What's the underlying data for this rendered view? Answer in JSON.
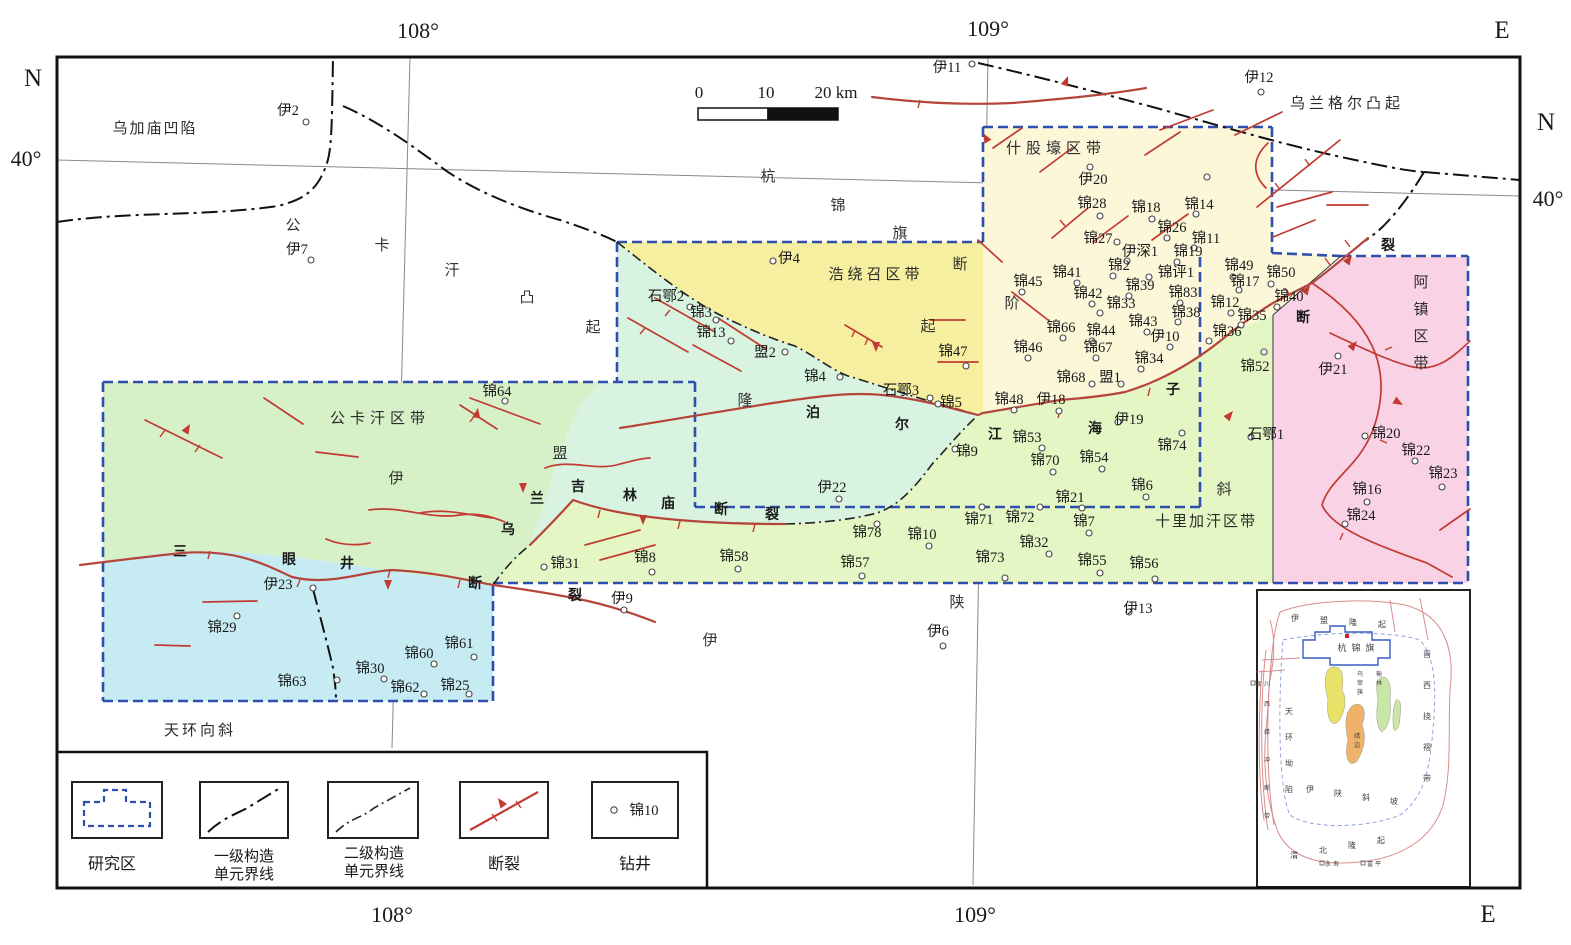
{
  "palette": {
    "study_boundary": "#2e4fae",
    "fault_red": "#c23b32",
    "fault_main": "#b5453b",
    "green_gongkahan": "#d6f0c8",
    "cyan_sanyanjing": "#c6ebf3",
    "mint_long": "#d9f3e1",
    "yellow_haoraozhao": "#f6ef9f",
    "pale_shiguhao": "#fbf7d8",
    "band_shilijiahan": "#e3f6c4",
    "pink_azhen": "#f9d3e5",
    "inset_yellow": "#e9e268",
    "inset_orange": "#efb26b",
    "inset_green": "#c9e6a5"
  },
  "graticule": {
    "top_lon_left": "108°",
    "top_lon_right": "109°",
    "bottom_lon_left": "108°",
    "bottom_lon_right": "109°",
    "left_lat": "40°",
    "right_lat": "40°"
  },
  "compass": {
    "top_e": "E",
    "bottom_e": "E",
    "left_n": "N",
    "right_n": "N"
  },
  "scale_bar": {
    "t0": "0",
    "t10": "10",
    "t20": "20 km"
  },
  "region_labels": [
    {
      "text": "乌加庙凹陷",
      "x": 155,
      "y": 133,
      "ls": 2,
      "size": 15
    },
    {
      "text": "公卡汗区带",
      "x": 380,
      "y": 423,
      "ls": 5,
      "size": 15
    },
    {
      "text": "浩绕召区带",
      "x": 876,
      "y": 279,
      "ls": 4,
      "size": 15
    },
    {
      "text": "什股壕区带",
      "x": 1056,
      "y": 153,
      "ls": 5,
      "size": 15
    },
    {
      "text": "乌兰格尔凸起",
      "x": 1347,
      "y": 108,
      "ls": 4,
      "size": 15
    },
    {
      "text": "十里加汗区带",
      "x": 1206,
      "y": 526,
      "ls": 2,
      "size": 15
    },
    {
      "text": "阿镇区带",
      "x": 1421,
      "y": 287,
      "vertical": true,
      "vs": 27,
      "size": 15
    },
    {
      "text": "天环向斜",
      "x": 200,
      "y": 735,
      "ls": 3,
      "size": 15
    }
  ],
  "scatter_chars": [
    [
      "公",
      293,
      225
    ],
    [
      "卡",
      382,
      245
    ],
    [
      "汗",
      452,
      270
    ],
    [
      "凸",
      527,
      297
    ],
    [
      "起",
      593,
      327
    ],
    [
      "杭",
      768,
      176
    ],
    [
      "锦",
      838,
      205
    ],
    [
      "旗",
      900,
      233
    ],
    [
      "断",
      960,
      264
    ],
    [
      "阶",
      1012,
      303
    ],
    [
      "起",
      928,
      326
    ],
    [
      "隆",
      745,
      400
    ],
    [
      "盟",
      560,
      453
    ],
    [
      "伊",
      396,
      478
    ],
    [
      "伊",
      710,
      640
    ],
    [
      "陕",
      957,
      602
    ],
    [
      "斜",
      1224,
      489
    ]
  ],
  "fault_names": [
    {
      "name": "三眼井断裂",
      "chars": [
        [
          "三",
          180,
          551
        ],
        [
          "眼",
          289,
          559
        ],
        [
          "井",
          347,
          563
        ],
        [
          "断",
          475,
          583
        ],
        [
          "裂",
          575,
          595
        ]
      ]
    },
    {
      "name": "乌兰吉林庙断裂",
      "chars": [
        [
          "乌",
          508,
          529
        ],
        [
          "兰",
          537,
          498
        ],
        [
          "吉",
          578,
          486
        ],
        [
          "林",
          630,
          495
        ],
        [
          "庙",
          668,
          503
        ],
        [
          "断",
          721,
          509
        ],
        [
          "裂",
          772,
          514
        ]
      ]
    },
    {
      "name": "泊尔江海子断裂",
      "chars": [
        [
          "泊",
          813,
          412
        ],
        [
          "尔",
          902,
          424
        ],
        [
          "江",
          995,
          434
        ],
        [
          "海",
          1095,
          428
        ],
        [
          "子",
          1173,
          389
        ]
      ]
    },
    {
      "name": "断裂",
      "chars": [
        [
          "断",
          1303,
          317
        ],
        [
          "裂",
          1388,
          245
        ]
      ]
    }
  ],
  "wells": [
    [
      "伊2",
      288,
      110,
      306,
      122
    ],
    [
      "伊7",
      297,
      249,
      311,
      260
    ],
    [
      "伊4",
      789,
      258,
      773,
      261
    ],
    [
      "伊11",
      947,
      67,
      972,
      64
    ],
    [
      "伊12",
      1259,
      77,
      1261,
      92
    ],
    [
      "石鄂2",
      666,
      296,
      690,
      307
    ],
    [
      "锦3",
      701,
      312,
      716,
      320
    ],
    [
      "锦13",
      711,
      332,
      731,
      341
    ],
    [
      "盟2",
      765,
      352,
      785,
      352
    ],
    [
      "锦4",
      815,
      376,
      840,
      377
    ],
    [
      "锦64",
      497,
      391,
      505,
      401
    ],
    [
      "石鄂3",
      901,
      390,
      930,
      398
    ],
    [
      "锦5",
      951,
      402,
      938,
      404
    ],
    [
      "锦47",
      953,
      351,
      966,
      366
    ],
    [
      "伊20",
      1093,
      179,
      1090,
      167
    ],
    [
      "锦28",
      1092,
      203,
      1100,
      216
    ],
    [
      "锦18",
      1146,
      207,
      1152,
      219
    ],
    [
      "锦14",
      1199,
      204,
      1196,
      214
    ],
    [
      "锦26",
      1172,
      227,
      1167,
      238
    ],
    [
      "锦11",
      1206,
      238,
      1194,
      248
    ],
    [
      "锦27",
      1098,
      238,
      1117,
      242
    ],
    [
      "伊深1",
      1140,
      251,
      1127,
      261
    ],
    [
      "锦19",
      1188,
      251,
      1177,
      262
    ],
    [
      "锦2",
      1119,
      265,
      1113,
      276
    ],
    [
      "锦41",
      1067,
      272,
      1077,
      283
    ],
    [
      "锦45",
      1028,
      281,
      1022,
      292
    ],
    [
      "锦评1",
      1176,
      272,
      1149,
      277
    ],
    [
      "锦49",
      1239,
      265,
      1233,
      277
    ],
    [
      "锦50",
      1281,
      272,
      1271,
      284
    ],
    [
      "锦17",
      1245,
      281,
      1239,
      290
    ],
    [
      "锦42",
      1088,
      293,
      1092,
      304
    ],
    [
      "锦39",
      1140,
      285,
      1129,
      296
    ],
    [
      "锦83",
      1183,
      292,
      1180,
      303
    ],
    [
      "锦40",
      1289,
      296,
      1277,
      307
    ],
    [
      "锦33",
      1121,
      303,
      1100,
      313
    ],
    [
      "锦38",
      1186,
      312,
      1178,
      322
    ],
    [
      "锦12",
      1225,
      302,
      1231,
      313
    ],
    [
      "锦35",
      1252,
      315,
      1241,
      325
    ],
    [
      "锦66",
      1061,
      327,
      1063,
      338
    ],
    [
      "锦44",
      1101,
      330,
      1092,
      341
    ],
    [
      "锦43",
      1143,
      321,
      1147,
      332
    ],
    [
      "伊10",
      1165,
      336,
      1170,
      347
    ],
    [
      "锦36",
      1227,
      331,
      1209,
      341
    ],
    [
      "锦46",
      1028,
      347,
      1028,
      358
    ],
    [
      "锦67",
      1098,
      347,
      1096,
      358
    ],
    [
      "锦34",
      1149,
      358,
      1141,
      369
    ],
    [
      "锦48",
      1009,
      399,
      1014,
      410
    ],
    [
      "伊18",
      1051,
      399,
      1059,
      411
    ],
    [
      "锦68",
      1071,
      377,
      1092,
      384
    ],
    [
      "盟1",
      1110,
      377,
      1121,
      384
    ],
    [
      "伊19",
      1129,
      419,
      1118,
      422
    ],
    [
      "锦9",
      967,
      451,
      955,
      449
    ],
    [
      "锦52",
      1255,
      366,
      1264,
      352
    ],
    [
      "伊21",
      1333,
      369,
      1338,
      356
    ],
    [
      "石鄂1",
      1266,
      434,
      1251,
      437
    ],
    [
      "锦53",
      1027,
      437,
      1042,
      448
    ],
    [
      "锦70",
      1045,
      460,
      1053,
      472
    ],
    [
      "锦54",
      1094,
      457,
      1102,
      469
    ],
    [
      "锦74",
      1172,
      445,
      1182,
      433
    ],
    [
      "锦6",
      1142,
      485,
      1146,
      497
    ],
    [
      "锦21",
      1070,
      497,
      1082,
      508
    ],
    [
      "锦71",
      979,
      519,
      982,
      507
    ],
    [
      "锦72",
      1020,
      517,
      1040,
      507
    ],
    [
      "锦7",
      1084,
      521,
      1089,
      533
    ],
    [
      "锦32",
      1034,
      542,
      1049,
      554
    ],
    [
      "锦73",
      990,
      557,
      1005,
      578
    ],
    [
      "锦55",
      1092,
      560,
      1100,
      573
    ],
    [
      "锦56",
      1144,
      563,
      1155,
      579
    ],
    [
      "锦78",
      867,
      532,
      877,
      524
    ],
    [
      "锦10",
      922,
      534,
      929,
      546
    ],
    [
      "锦58",
      734,
      556,
      738,
      569
    ],
    [
      "锦57",
      855,
      562,
      862,
      576
    ],
    [
      "锦8",
      645,
      557,
      652,
      572
    ],
    [
      "锦31",
      565,
      563,
      544,
      567
    ],
    [
      "伊22",
      832,
      487,
      839,
      499
    ],
    [
      "伊9",
      622,
      598,
      624,
      610
    ],
    [
      "伊23",
      278,
      584,
      313,
      588
    ],
    [
      "锦29",
      222,
      627,
      237,
      616
    ],
    [
      "锦63",
      292,
      681,
      337,
      680
    ],
    [
      "锦30",
      370,
      668,
      384,
      679
    ],
    [
      "锦60",
      419,
      653,
      434,
      664
    ],
    [
      "锦61",
      459,
      643,
      474,
      657
    ],
    [
      "锦62",
      405,
      687,
      424,
      694
    ],
    [
      "锦25",
      455,
      685,
      469,
      694
    ],
    [
      "伊6",
      938,
      631,
      943,
      646
    ],
    [
      "伊13",
      1138,
      608,
      1129,
      612
    ],
    [
      "锦20",
      1386,
      433,
      1365,
      436
    ],
    [
      "锦22",
      1416,
      450,
      1415,
      461
    ],
    [
      "锦23",
      1443,
      473,
      1442,
      487
    ],
    [
      "锦16",
      1367,
      489,
      1367,
      502
    ],
    [
      "锦24",
      1361,
      515,
      1345,
      524
    ],
    [
      "",
      0,
      0,
      1207,
      177
    ]
  ],
  "legend": {
    "study_area": "研究区",
    "first_order_1": "一级构造",
    "first_order_2": "单元界线",
    "second_order_1": "二级构造",
    "second_order_2": "单元界线",
    "fault": "断裂",
    "well": "钻井",
    "well_sample": "锦10"
  },
  "inset": {
    "labels": [
      {
        "text": "伊盟隆起",
        "x": 1295,
        "y": 621,
        "dx": 29,
        "dy": 2,
        "size": 8
      },
      {
        "text": "杭锦旗",
        "x": 1342,
        "y": 651,
        "dx": 14,
        "dy": 0,
        "size": 9
      },
      {
        "text": "晋西挠褶带",
        "x": 1427,
        "y": 657,
        "dx": 0,
        "dy": 31,
        "size": 8
      },
      {
        "text": "天环坳陷",
        "x": 1289,
        "y": 714,
        "dx": 0,
        "dy": 26,
        "size": 8
      },
      {
        "text": "西缘冲断带",
        "x": 1267,
        "y": 706,
        "dx": 0,
        "dy": 28,
        "size": 6
      },
      {
        "text": "伊陕斜坡",
        "x": 1310,
        "y": 792,
        "dx": 28,
        "dy": 4,
        "size": 8
      },
      {
        "text": "渭北隆起",
        "x": 1294,
        "y": 858,
        "dx": 29,
        "dy": -5,
        "size": 8
      },
      {
        "text": "银川",
        "x": 1258,
        "y": 686,
        "dx": 9,
        "dy": 0,
        "size": 6
      },
      {
        "text": "乌审旗",
        "x": 1360,
        "y": 676,
        "dx": 0,
        "dy": 9,
        "size": 6
      },
      {
        "text": "榆林",
        "x": 1379,
        "y": 676,
        "dx": 0,
        "dy": 9,
        "size": 6
      },
      {
        "text": "靖边",
        "x": 1357,
        "y": 738,
        "dx": 0,
        "dy": 9,
        "size": 6
      },
      {
        "text": "永寿",
        "x": 1328,
        "y": 866,
        "dx": 8,
        "dy": 0,
        "size": 6
      },
      {
        "text": "富平",
        "x": 1370,
        "y": 866,
        "dx": 8,
        "dy": 0,
        "size": 6
      }
    ]
  }
}
